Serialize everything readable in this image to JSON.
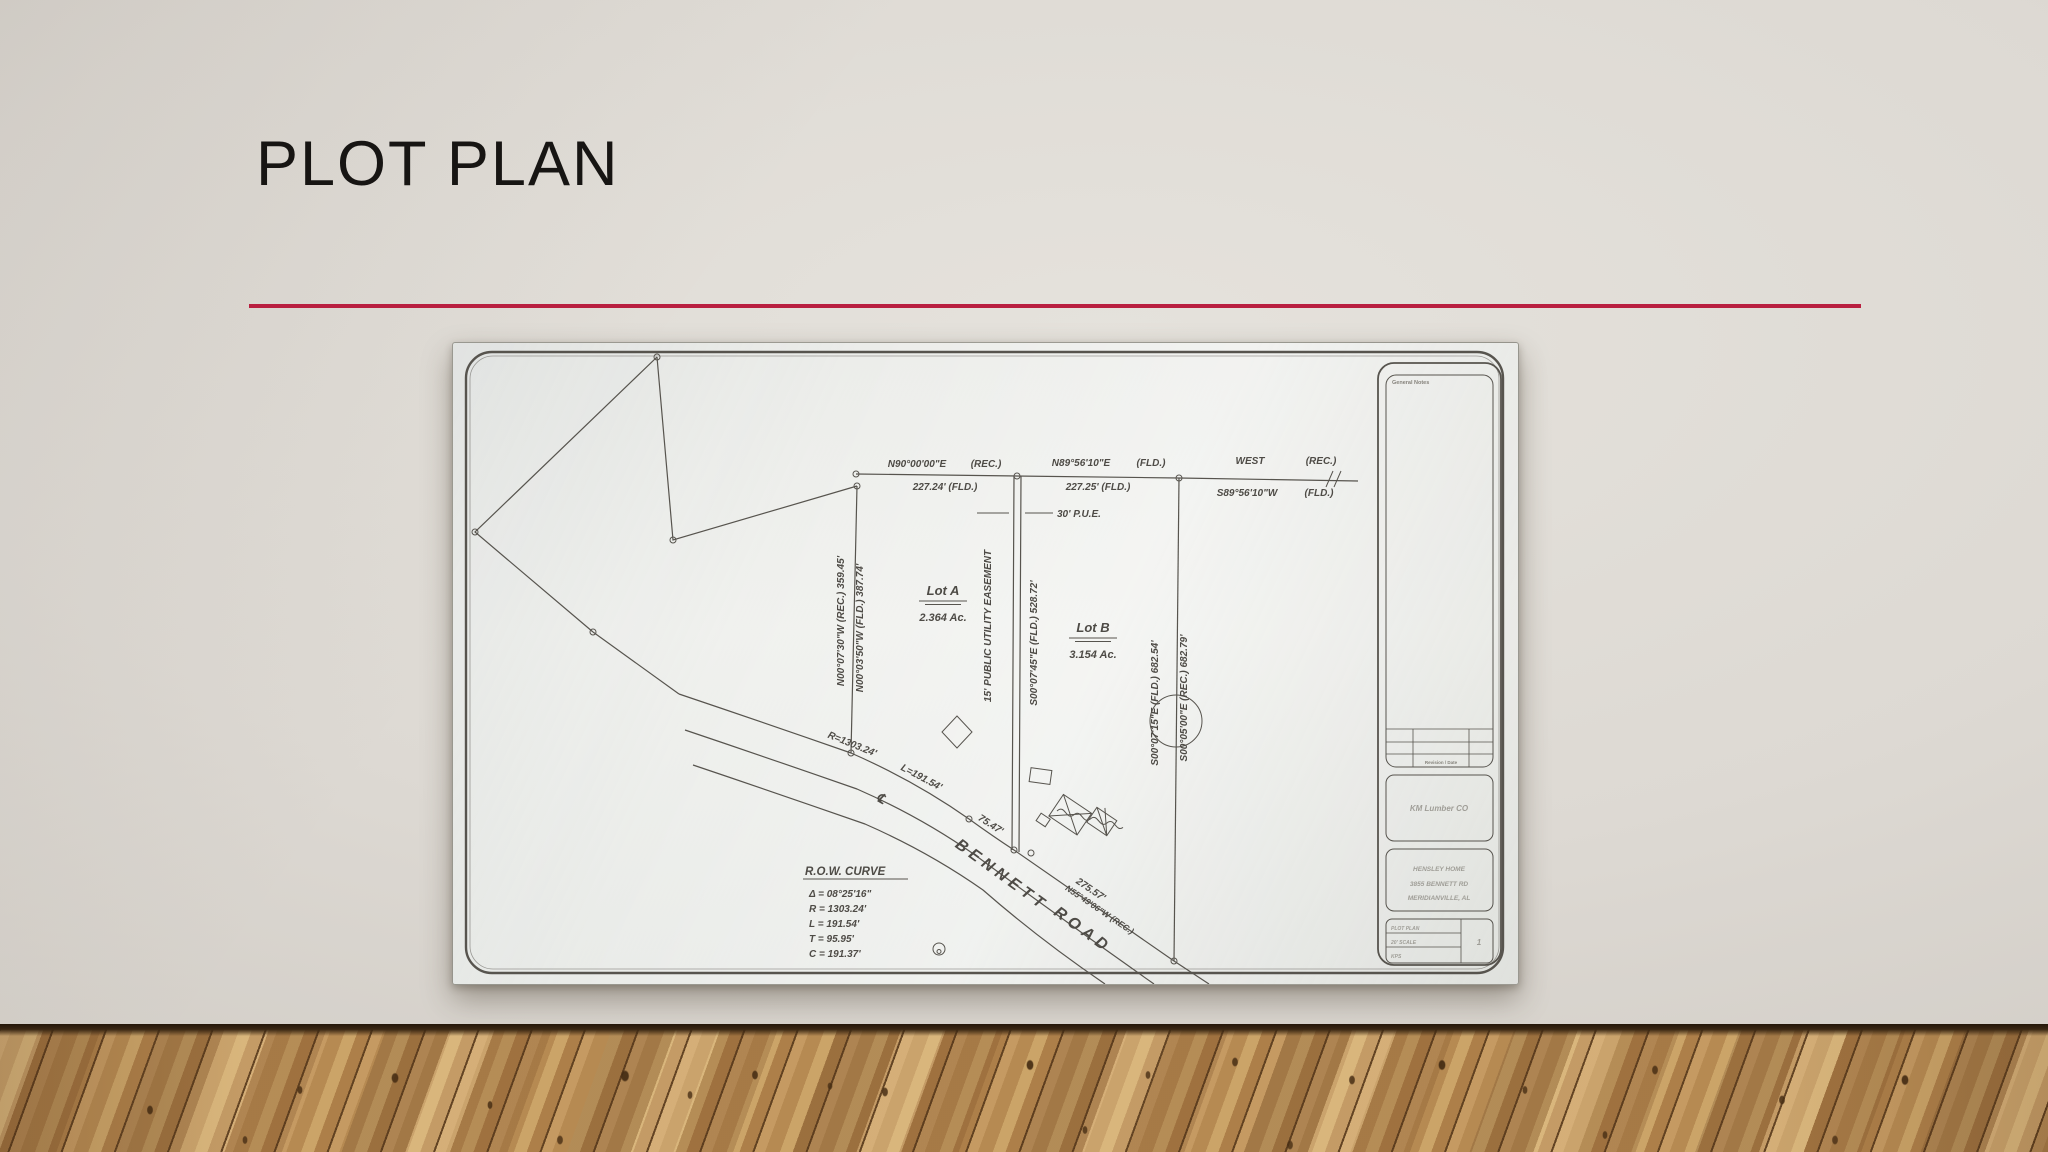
{
  "slide": {
    "title": "PLOT PLAN",
    "accent_color": "#b91f40"
  },
  "drawing": {
    "top": {
      "b1": "N90°00'00\"E",
      "b1b": "(REC.)",
      "d1": "227.24' (FLD.)",
      "b2": "N89°56'10\"E",
      "b2b": "(FLD.)",
      "d2": "227.25' (FLD.)",
      "b3": "WEST",
      "b3b": "(REC.)",
      "b3alt": "S89°56'10\"W",
      "b3altb": "(FLD.)",
      "pue": "30' P.U.E."
    },
    "west_line": {
      "rec": "N00°07'30\"W  (REC.)  359.45'",
      "fld": "N00°03'50\"W  (FLD.)  387.74'"
    },
    "easement": {
      "label": "15' PUBLIC UTILITY EASEMENT",
      "fld": "S00°07'45\"E  (FLD.)  528.72'"
    },
    "east_line": {
      "fld": "S00°07'15\"E  (FLD.)  682.54'",
      "rec": "S00°05'00\"E  (REC.)  682.79'"
    },
    "lots": [
      {
        "name": "Lot A",
        "area": "2.364 Ac."
      },
      {
        "name": "Lot B",
        "area": "3.154 Ac."
      }
    ],
    "road": {
      "name1": "BENNETT",
      "name2": "ROAD",
      "r": "R=1303.24'",
      "l": "L=191.54'",
      "seg": "75.47'",
      "dist": "275.57'",
      "bearing": "N55°49'06\"W (REC.)",
      "cl": "℄"
    },
    "row_curve": {
      "title": "R.O.W. CURVE",
      "delta": "Δ = 08°25'16\"",
      "r": "R = 1303.24'",
      "l": "L = 191.54'",
      "t": "T = 95.95'",
      "c": "C = 191.37'"
    },
    "title_block": {
      "notes": "General Notes",
      "rev": "Revision / Date",
      "company": "KM Lumber CO",
      "addr1": "HENSLEY HOME",
      "addr2": "3855 BENNETT RD",
      "addr3": "MERIDIANVILLE, AL",
      "r1": "PLOT PLAN",
      "r2": "20' SCALE",
      "r3": "KPS",
      "sheet": "1"
    }
  }
}
